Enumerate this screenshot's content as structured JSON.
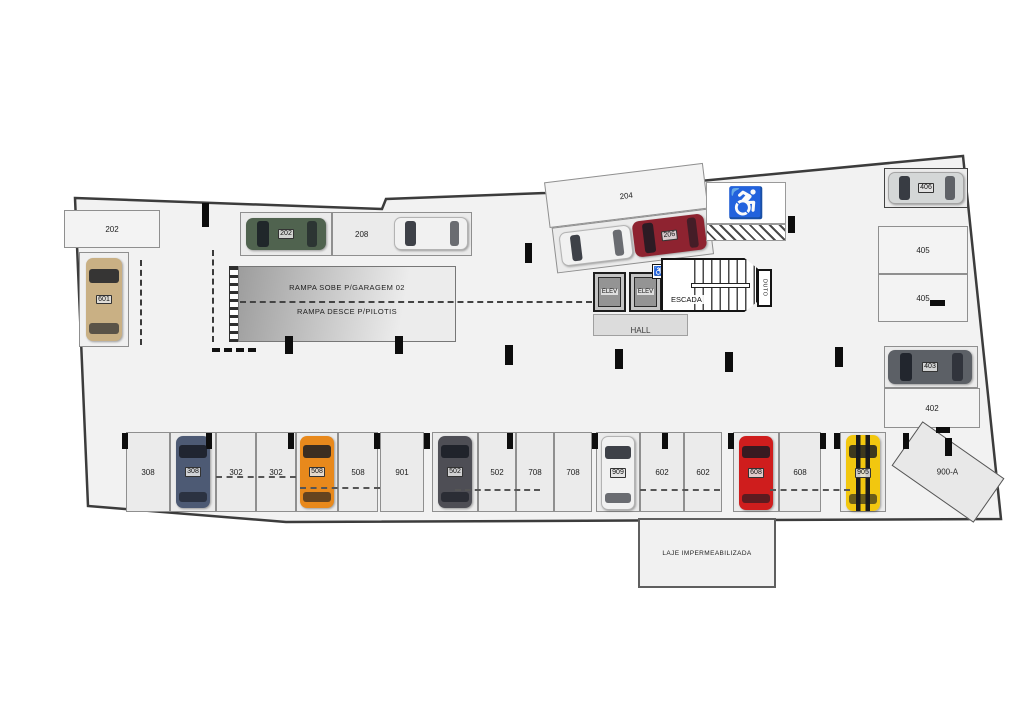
{
  "plan_type": "parking-garage-floor-plan",
  "colors": {
    "floor_fill": "#f2f2f2",
    "outline": "#3c3c3c",
    "accessible_icon": "#0f7d8c",
    "car_tan": "#c9b084",
    "car_green": "#50634f",
    "car_white": "#f1f1f1",
    "car_dark_red": "#8e2330",
    "car_silver": "#d4d7d7",
    "car_dark_gray": "#5c6066",
    "car_slate_blue": "#4d5a74",
    "car_orange": "#e8891c",
    "car_charcoal": "#4e4e55",
    "car_red": "#cf1d1d",
    "car_yellow": "#f2c70f"
  },
  "icons": {
    "wheelchair": "♿"
  },
  "ramp": {
    "line1": "RAMPA SOBE P/GARAGEM 02",
    "line2": "RAMPA DESCE P/PILOTIS"
  },
  "core": {
    "elev_left": "ELEV",
    "elev_right": "ELEV",
    "stairs": "ESCADA",
    "hall": "HALL",
    "duct": "DUTO"
  },
  "slab_note": "LAJE IMPERMEABILIZADA",
  "top": {
    "spot202": "202",
    "car601": "601",
    "car202": "202",
    "spot208": "208",
    "spot204": "204",
    "car206": "206",
    "car406": "406",
    "spot405a": "405",
    "spot405b": "405",
    "car403": "403",
    "spot402": "402"
  },
  "bottom_row": [
    {
      "label": "308",
      "occupied": false
    },
    {
      "label": "308",
      "occupied": true,
      "car_color": "#4d5a74"
    },
    {
      "label": "302",
      "occupied": false
    },
    {
      "label": "302",
      "occupied": false
    },
    {
      "label": "508",
      "occupied": true,
      "car_color": "#e8891c"
    },
    {
      "label": "508",
      "occupied": false
    },
    {
      "label": "901",
      "occupied": false
    },
    {
      "label": "502",
      "occupied": true,
      "car_color": "#4e4e55"
    },
    {
      "label": "502",
      "occupied": false
    },
    {
      "label": "708",
      "occupied": false
    },
    {
      "label": "708",
      "occupied": false
    },
    {
      "label": "909",
      "occupied": true,
      "car_color": "#f1f1f1"
    },
    {
      "label": "602",
      "occupied": false
    },
    {
      "label": "602",
      "occupied": false
    },
    {
      "label": "608",
      "occupied": true,
      "car_color": "#cf1d1d"
    },
    {
      "label": "608",
      "occupied": false
    },
    {
      "label": "905",
      "occupied": true,
      "car_color": "#f2c70f"
    },
    {
      "label": "900-A",
      "occupied": false,
      "diagonal": true
    }
  ]
}
